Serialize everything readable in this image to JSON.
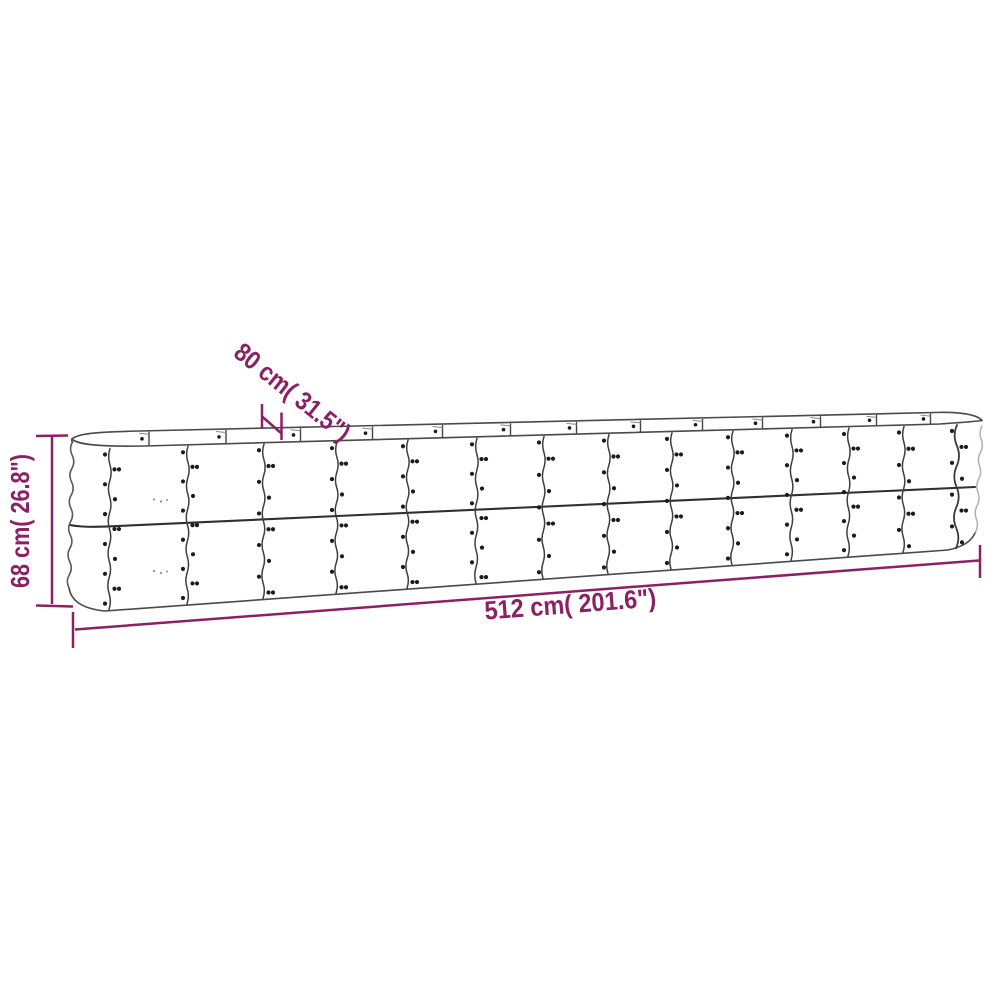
{
  "page": {
    "background_color": "#ffffff"
  },
  "diagram": {
    "colors": {
      "accent": "#8b2164",
      "outline": "#4a4a4a",
      "outline_light": "#b0b0b0",
      "rivet": "#1c1c1c"
    },
    "dimensions": {
      "height": {
        "label": "68 cm( 26.8\")"
      },
      "width": {
        "label": "80 cm( 31.5\")"
      },
      "length": {
        "label": "512 cm( 201.6\")"
      }
    }
  }
}
